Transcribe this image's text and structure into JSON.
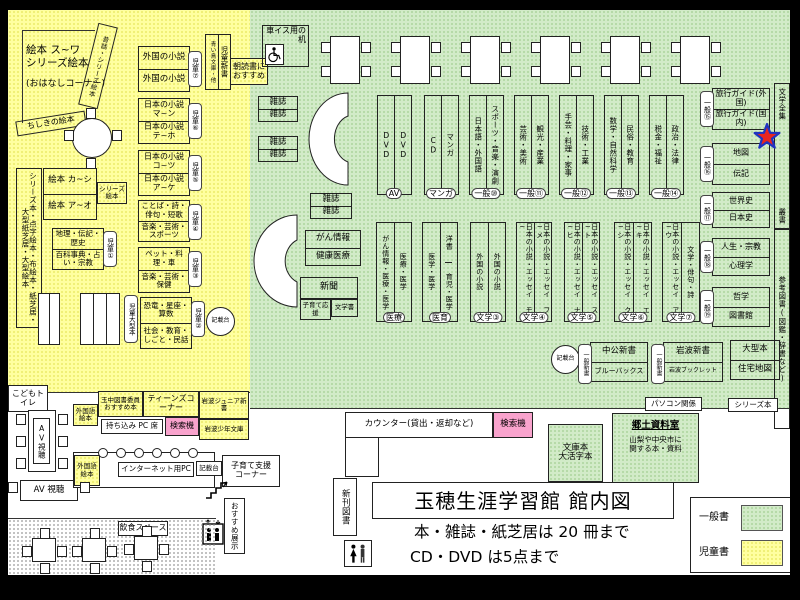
{
  "palette": {
    "general_green": "#d2ebc8",
    "children_yellow": "#ffffa0",
    "search_pink": "#f9a3cd",
    "star_red": "#e8251f",
    "star_blue": "#2033c0"
  },
  "children_area": {
    "ohanashi": {
      "line1": "絵本 ス~ワ",
      "line2": "シリーズ絵本",
      "line3": "(おはなしコーナー)"
    },
    "mukashibanashi_shelf": "昔話・シリーズ絵本",
    "chishiki_shelf": "ちしきの絵本",
    "tall_shelf": "シリーズ本・点字絵本・布絵本・紙芝居・大型紙芝居・大型絵本",
    "ehon_box": {
      "top": "絵本 カ~シ",
      "bottom": "絵本 ア~オ",
      "side_tag": "シリーズ絵本"
    },
    "chiri_box": {
      "top": "地理・伝記・歴史",
      "bottom": "百科事典・占い・宗教",
      "tag": "児童①"
    },
    "gaikoku_box": {
      "top": "外国の小説",
      "bottom": "外国の小説",
      "tag": "児童⑦"
    },
    "jidou_shinsho": {
      "main": "児童新書",
      "sub": "青い鳥文庫・他"
    },
    "asadoku": "朝読書におすすめ",
    "nihon_ma_box": {
      "top": "日本の小説 マ~ン",
      "bottom": "日本の小説 テ~ホ",
      "tag": "児童⑥"
    },
    "nihon_ko_box": {
      "top": "日本の小説 コ~ツ",
      "bottom": "日本の小説 ア~ケ",
      "tag": "児童⑤"
    },
    "kotoba_box": {
      "top": "ことば・詩・俳句・短歌",
      "bottom": "音楽・芸術・スポーツ",
      "tag": "児童④"
    },
    "pet_box": {
      "top": "ペット・料理・車",
      "bottom": "音楽・芸術・保健",
      "tag": "児童③"
    },
    "kyoryu_box": {
      "top": "恐竜・星座・算数",
      "bottom": "社会・教育・しごと・民話",
      "tag": "児童②"
    },
    "jidou_ogata_tag": "児童大型本",
    "kisaidai": "記載台",
    "kodomo_toilet": "こどもトイレ"
  },
  "general_area": {
    "wheelchair_desk": "車イス用の机",
    "magazine": "雑誌",
    "gan_box": {
      "top": "がん情報",
      "bottom": "健康医療"
    },
    "shinbun_box": {
      "top": "新聞",
      "sub_left": "子育て応援",
      "sub_right": "文学書"
    },
    "row_a": [
      {
        "left": "DVD",
        "right": "DVD",
        "tag": "AV"
      },
      {
        "left": "CD",
        "right": "マンガ",
        "tag": "マンガ"
      },
      {
        "left": "日本語・外国語",
        "right": "スポーツ・音楽・演劇",
        "tag": "一般⑩"
      },
      {
        "left": "芸術・美術",
        "right": "観光・産業",
        "tag": "一般⑪"
      },
      {
        "left": "手芸・料理・家事",
        "right": "技術・工業",
        "tag": "一般⑫"
      },
      {
        "left": "数学・自然科学",
        "right": "民俗・教育",
        "tag": "一般⑬"
      },
      {
        "left": "税金・福祉",
        "right": "政治・法律",
        "tag": "一般⑭"
      }
    ],
    "row_b": [
      {
        "left": "がん情報・医療・医学",
        "right": "医療・医学",
        "tag": "医療"
      },
      {
        "left": "医学・医学",
        "right_top": "洋書",
        "right_bottom": "育児・医学",
        "tag": "医育"
      },
      {
        "left": "外国の小説",
        "right": "外国の小説",
        "tag": "文学③"
      },
      {
        "left": "日本の小説・エッセイ モ~",
        "right": "日本の小説・エッセイ フ~メ",
        "tag": "文学④"
      },
      {
        "left": "日本の小説・エッセイ ナ~ヒ",
        "right": "日本の小説・エッセイ ス~ト",
        "tag": "文学⑤"
      },
      {
        "left": "日本の小説・エッセイ ク~シ",
        "right": "日本の小説・エッセイ エ~キ",
        "tag": "文学⑥"
      },
      {
        "left": "日本の小説・エッセイ ア~ウ",
        "right": "文学・俳句・詩",
        "tag": "文学⑦"
      }
    ],
    "right_col": [
      {
        "top": "旅行ガイド(外国)",
        "bottom": "旅行ガイド(国内)",
        "tag": "一般⑮"
      },
      {
        "top": "地図",
        "bottom": "伝記",
        "tag": "一般⑯"
      },
      {
        "top": "世界史",
        "bottom": "日本史",
        "tag": "一般⑰"
      },
      {
        "top": "人生・宗教",
        "bottom": "心理学",
        "tag": "一般⑱"
      },
      {
        "top": "哲学",
        "bottom": "図書館",
        "tag": "一般⑲"
      }
    ],
    "right_strip": {
      "top": "文学全集",
      "mid": "叢書",
      "bottom": "参考図書(図鑑・辞書など)"
    },
    "shinsho_row": [
      {
        "tag": "一般新書",
        "top": "中公新書",
        "bottom": "ブルーバックス"
      },
      {
        "tag": "一般新書",
        "top": "岩波新書",
        "bottom": "岩波ブックレット"
      }
    ],
    "ogata_box": {
      "top": "大型本",
      "bottom": "住宅地図"
    },
    "pasokon_tag": "パソコン関係",
    "series_tag": "シリーズ本",
    "kisaidai": "記載台"
  },
  "service_area": {
    "counter": "カウンター(貸出・返却など)",
    "search": "検索機",
    "bunko_box": {
      "line1": "文庫本",
      "line2": "大活字本"
    },
    "kyodo_room": {
      "title": "郷土資料室",
      "desc1": "山梨や中央市に",
      "desc2": "関する本・資料"
    },
    "shinkan": "新刊図書"
  },
  "teens_area": {
    "gaikokugo_ehon": "外国語絵本",
    "tamachu": "玉中図書委員おすすめ本",
    "teens_corner": "ティーンズコーナー",
    "iwanami_junior": "岩波ジュニア新書",
    "mochikomi_pc": "持ち込み PC 席",
    "search": "検索機",
    "iwanami_shonen": "岩波少年文庫"
  },
  "bottom_area": {
    "av_1": "AV視聴",
    "av_2": "AV 視聴",
    "gaikokugo_ehon": "外国語絵本",
    "internet_pc": "インターネット用PC",
    "kisaidai": "記載台",
    "kosodate": {
      "line1": "子育て支援",
      "line2": "コーナー"
    },
    "osusume": "おすすめ展示",
    "inshoku": "飲食スペース"
  },
  "footer": {
    "title": "玉穂生涯学習館 館内図",
    "note1": "本・雑誌・紙芝居は 20 冊まで",
    "note2": "CD・DVD は5点まで"
  },
  "legend": {
    "general": "一般書",
    "children": "児童書"
  }
}
